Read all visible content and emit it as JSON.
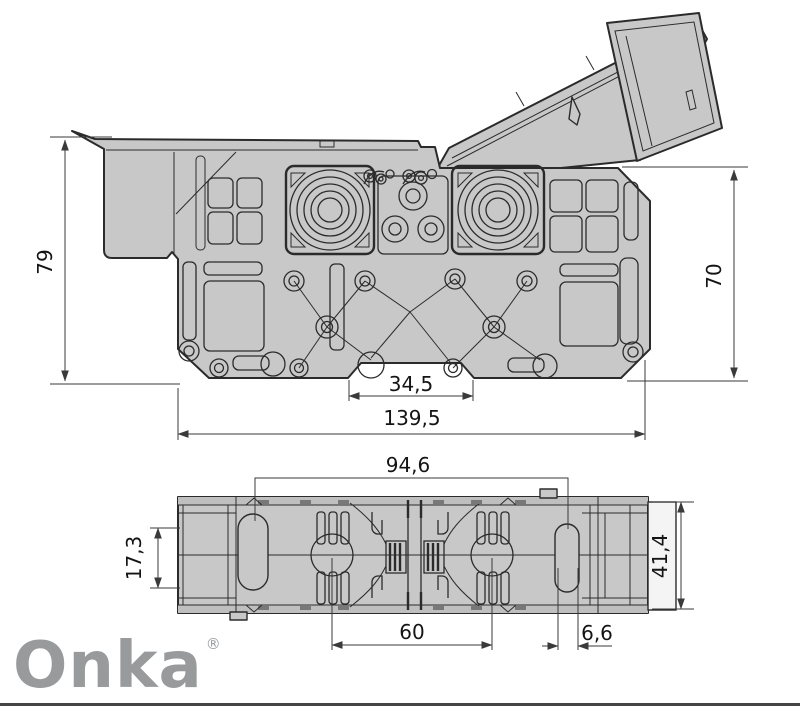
{
  "page": {
    "background": "#ffffff",
    "footer_rule_color": "#454545"
  },
  "logo": {
    "brand": "Onka",
    "registered_mark": "®",
    "color": "#989a9c"
  },
  "drawing": {
    "type": "technical-dimension-drawing",
    "subject": "DIN-rail terminal block with hinged cover, side view and top view",
    "part_fill": "#c8c8c8",
    "line_color": "#2b2b2b",
    "dimension_color": "#3a3a3a"
  },
  "dimensions": {
    "side_view": {
      "height_left": "79",
      "height_right": "70",
      "rail_notch_width": "34,5",
      "overall_length": "139,5"
    },
    "top_view": {
      "cover_span": "94,6",
      "left_slot_height": "17,3",
      "overall_width": "41,4",
      "center_spacing": "60",
      "slot_width": "6,6"
    }
  }
}
